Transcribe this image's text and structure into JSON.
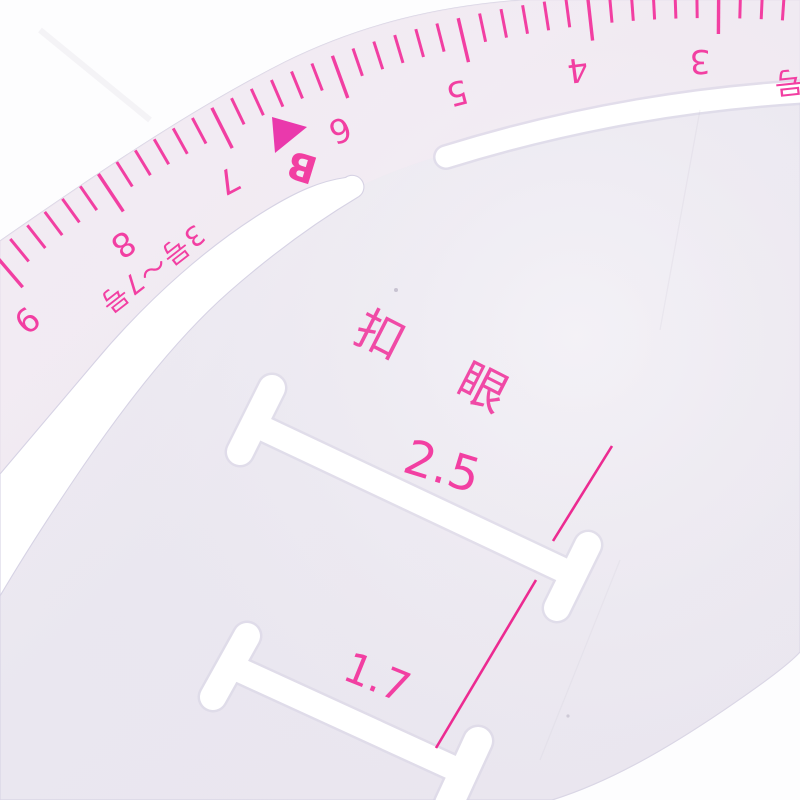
{
  "scale": {
    "numbers": [
      "9",
      "8",
      "7",
      "6",
      "5",
      "4",
      "3"
    ],
    "unit_label": "号",
    "range_label": "3号～7号",
    "pointer_label": "B"
  },
  "buttonhole": {
    "title": "扣  眼",
    "sizes": [
      "2.5",
      "1.7"
    ]
  },
  "colors": {
    "ink": "#f23fa2",
    "line": "#ec2b91",
    "body": "#ebe8f0",
    "background": "#fdfdfe",
    "slot_edge": "#d6d2e4"
  }
}
